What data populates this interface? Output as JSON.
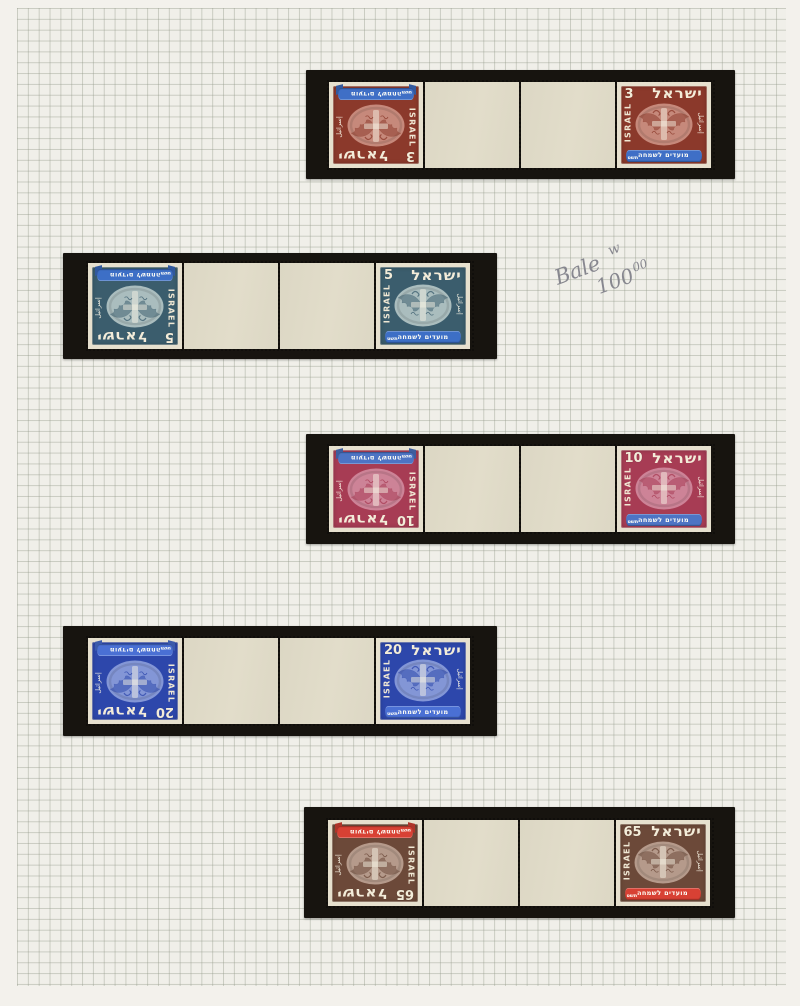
{
  "page": {
    "margin_color": "#f3f1ec",
    "grid_bg_color": "#f0efe9",
    "grid_line_color": "rgba(148,154,138,0.42)",
    "mount_color": "#17140f",
    "stamp_paper_color": "#e6e0ce",
    "gutter_tab_color": "#dcd7c4"
  },
  "handwritten_note": {
    "word": "Bale",
    "sup": "w",
    "amount": "100",
    "amount_sup": "00"
  },
  "stamp_labels": {
    "country_hebrew": "ישראל",
    "country_latin": "ISRAEL",
    "country_arabic": "إسرائيل",
    "ribbon_text": "מועדים לשמחה",
    "ribbon_year": "תשט"
  },
  "strips": [
    {
      "value": "3",
      "color_name": "red-brown",
      "frame": "#8b392b",
      "oval": "#c6897b",
      "ribbon": "#3f6fc6"
    },
    {
      "value": "5",
      "color_name": "slate-teal",
      "frame": "#3b5d6d",
      "oval": "#aabdbe",
      "ribbon": "#3d6fc6"
    },
    {
      "value": "10",
      "color_name": "carmine",
      "frame": "#a73c54",
      "oval": "#cd8397",
      "ribbon": "#4d74c4"
    },
    {
      "value": "20",
      "color_name": "ultramarine",
      "frame": "#2d47ab",
      "oval": "#8396d6",
      "ribbon": "#4a70d4"
    },
    {
      "value": "65",
      "color_name": "brown",
      "frame": "#6c4939",
      "oval": "#b59a8b",
      "ribbon": "#d84134"
    }
  ]
}
